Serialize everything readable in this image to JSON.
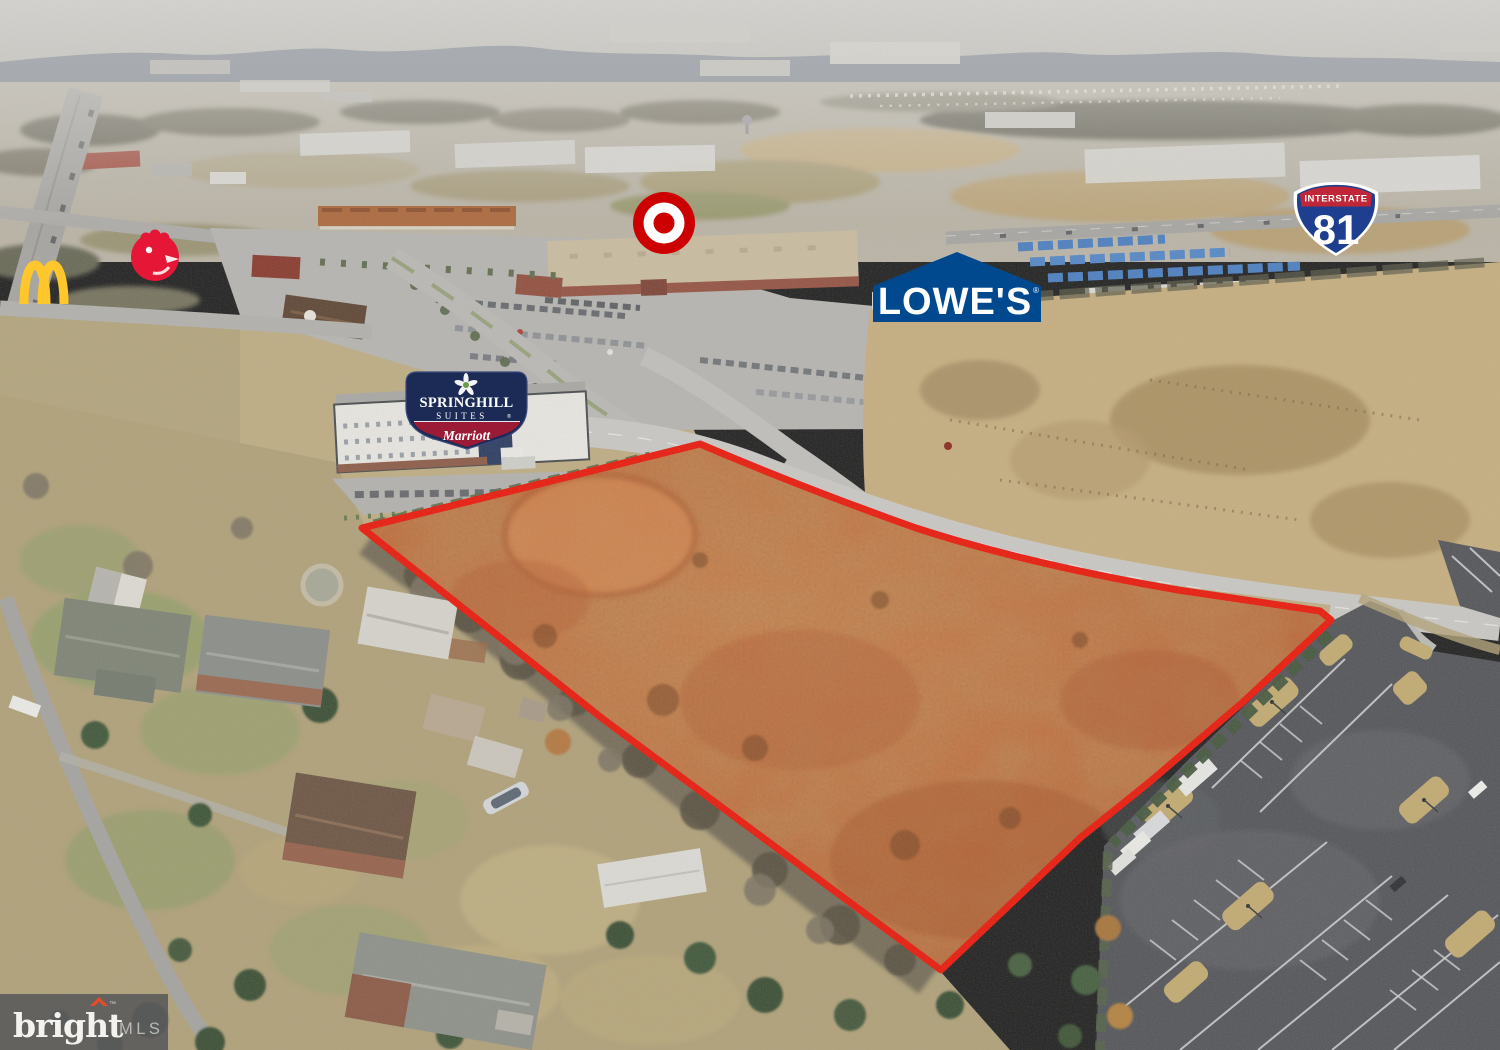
{
  "photo": {
    "description": "Aerial drone photograph of a vacant land parcel highlighted in orange with a red boundary outline, adjacent to a retail corridor with Target, Lowe's, Chick-fil-A, McDonald's, a SpringHill Suites hotel, Interstate 81, residential homes and a large parking lot"
  },
  "logos": {
    "mcdonalds": {
      "name": "McDonald's golden arches"
    },
    "chickfila": {
      "name": "Chick-fil-A chicken emblem"
    },
    "target": {
      "name": "Target bullseye"
    },
    "lowes": {
      "label": "LOWE'S",
      "registered": "®"
    },
    "springhill": {
      "line1": "SPRINGHILL",
      "line2": "SUITES",
      "registered": "®",
      "brand": "Marriott"
    },
    "interstate81": {
      "header": "INTERSTATE",
      "number": "81"
    }
  },
  "watermark": {
    "brand": "bright",
    "trademark": "™",
    "suffix": "MLS"
  },
  "colors": {
    "parcel_outline": "#ea1a0c",
    "parcel_fill": "#c96a38",
    "target_red": "#cc0000",
    "lowes_blue": "#00498f",
    "i81_blue": "#1e3f8f",
    "i81_red": "#bf2637",
    "mcdonalds_gold": "#ffc72c",
    "chickfila_red": "#e51636",
    "springhill_navy": "#1c2b56",
    "marriott_crimson": "#9b1b36",
    "watermark_bg": "#59595b"
  }
}
